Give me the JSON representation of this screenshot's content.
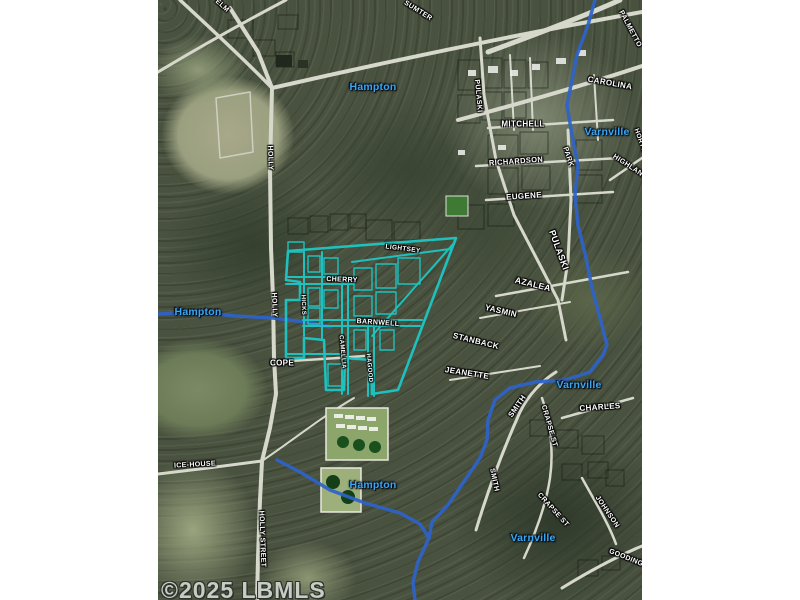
{
  "canvas": {
    "width": 800,
    "height": 600,
    "background": "#ffffff"
  },
  "map": {
    "left": 158,
    "top": 0,
    "width": 484,
    "height": 600
  },
  "colors": {
    "boundary_teal": "#1fc0bd",
    "river_blue": "#2e63c9",
    "town_label_blue": "#3ba7f0",
    "street_label_white": "#ffffff",
    "watermark_gray": "#c7ccc5",
    "road_light": "#d6d8cc",
    "pond_green": "#1a4f1e"
  },
  "watermark": {
    "text": "©2025 LBMLS"
  },
  "town_labels": [
    {
      "text": "Hampton",
      "x": 215,
      "y": 87,
      "rot": 0
    },
    {
      "text": "Varnville",
      "x": 449,
      "y": 132,
      "rot": 0
    },
    {
      "text": "Hampton",
      "x": 40,
      "y": 312,
      "rot": 0
    },
    {
      "text": "Varnville",
      "x": 421,
      "y": 385,
      "rot": 0
    },
    {
      "text": "Hampton",
      "x": 215,
      "y": 485,
      "rot": 0
    },
    {
      "text": "Varnville",
      "x": 375,
      "y": 538,
      "rot": 0
    }
  ],
  "street_labels": [
    {
      "text": "ELM",
      "x": 64,
      "y": 6,
      "rot": 42,
      "size": 7
    },
    {
      "text": "SUMTER",
      "x": 260,
      "y": 11,
      "rot": 32,
      "size": 7
    },
    {
      "text": "PALMETTO",
      "x": 472,
      "y": 29,
      "rot": 62,
      "size": 7
    },
    {
      "text": "CAROLINA",
      "x": 452,
      "y": 83,
      "rot": 10,
      "size": 8
    },
    {
      "text": "PULASKI",
      "x": 320,
      "y": 96,
      "rot": 85,
      "size": 7
    },
    {
      "text": "MITCHELL",
      "x": 365,
      "y": 124,
      "rot": 0,
      "size": 8
    },
    {
      "text": "HORTON",
      "x": 483,
      "y": 143,
      "rot": 70,
      "size": 6.5
    },
    {
      "text": "PARK",
      "x": 410,
      "y": 157,
      "rot": 72,
      "size": 7
    },
    {
      "text": "HIGHLAND",
      "x": 472,
      "y": 167,
      "rot": 33,
      "size": 7
    },
    {
      "text": "RICHARDSON",
      "x": 358,
      "y": 161,
      "rot": -4,
      "size": 7.5
    },
    {
      "text": "HOLLY",
      "x": 112,
      "y": 158,
      "rot": 88,
      "size": 7
    },
    {
      "text": "EUGENE",
      "x": 366,
      "y": 196,
      "rot": -4,
      "size": 8
    },
    {
      "text": "PULASKI",
      "x": 401,
      "y": 250,
      "rot": 70,
      "size": 9
    },
    {
      "text": "LIGHTSEY",
      "x": 245,
      "y": 249,
      "rot": 7,
      "size": 6.5
    },
    {
      "text": "AZALEA",
      "x": 375,
      "y": 284,
      "rot": 14,
      "size": 8.5
    },
    {
      "text": "HOLLY",
      "x": 116,
      "y": 305,
      "rot": 88,
      "size": 7
    },
    {
      "text": "HICKS",
      "x": 145,
      "y": 305,
      "rot": 88,
      "size": 6
    },
    {
      "text": "CHERRY",
      "x": 184,
      "y": 280,
      "rot": 2,
      "size": 7
    },
    {
      "text": "YASMIN",
      "x": 343,
      "y": 311,
      "rot": 13,
      "size": 8
    },
    {
      "text": "BARNWELL",
      "x": 220,
      "y": 323,
      "rot": 4,
      "size": 7
    },
    {
      "text": "STANBACK",
      "x": 318,
      "y": 341,
      "rot": 14,
      "size": 8
    },
    {
      "text": "CAMELLIA",
      "x": 184,
      "y": 352,
      "rot": 85,
      "size": 6
    },
    {
      "text": "HAGOOD",
      "x": 211,
      "y": 368,
      "rot": 85,
      "size": 6
    },
    {
      "text": "COPE",
      "x": 124,
      "y": 363,
      "rot": 0,
      "size": 8
    },
    {
      "text": "JEANETTE",
      "x": 309,
      "y": 373,
      "rot": 9,
      "size": 8
    },
    {
      "text": "SMITH",
      "x": 359,
      "y": 406,
      "rot": -55,
      "size": 7.5
    },
    {
      "text": "CHARLES",
      "x": 442,
      "y": 407,
      "rot": -4,
      "size": 8
    },
    {
      "text": "CRAPSE ST",
      "x": 391,
      "y": 426,
      "rot": 74,
      "size": 7
    },
    {
      "text": "ICE-HOUSE",
      "x": 37,
      "y": 465,
      "rot": -3,
      "size": 7
    },
    {
      "text": "SMITH",
      "x": 336,
      "y": 480,
      "rot": 78,
      "size": 7
    },
    {
      "text": "CRAPSE ST",
      "x": 395,
      "y": 510,
      "rot": 48,
      "size": 7
    },
    {
      "text": "JOHNSON",
      "x": 449,
      "y": 512,
      "rot": 56,
      "size": 7
    },
    {
      "text": "HOLLY STREET",
      "x": 104,
      "y": 539,
      "rot": 88,
      "size": 7
    },
    {
      "text": "GOODING",
      "x": 468,
      "y": 558,
      "rot": 22,
      "size": 7
    }
  ]
}
